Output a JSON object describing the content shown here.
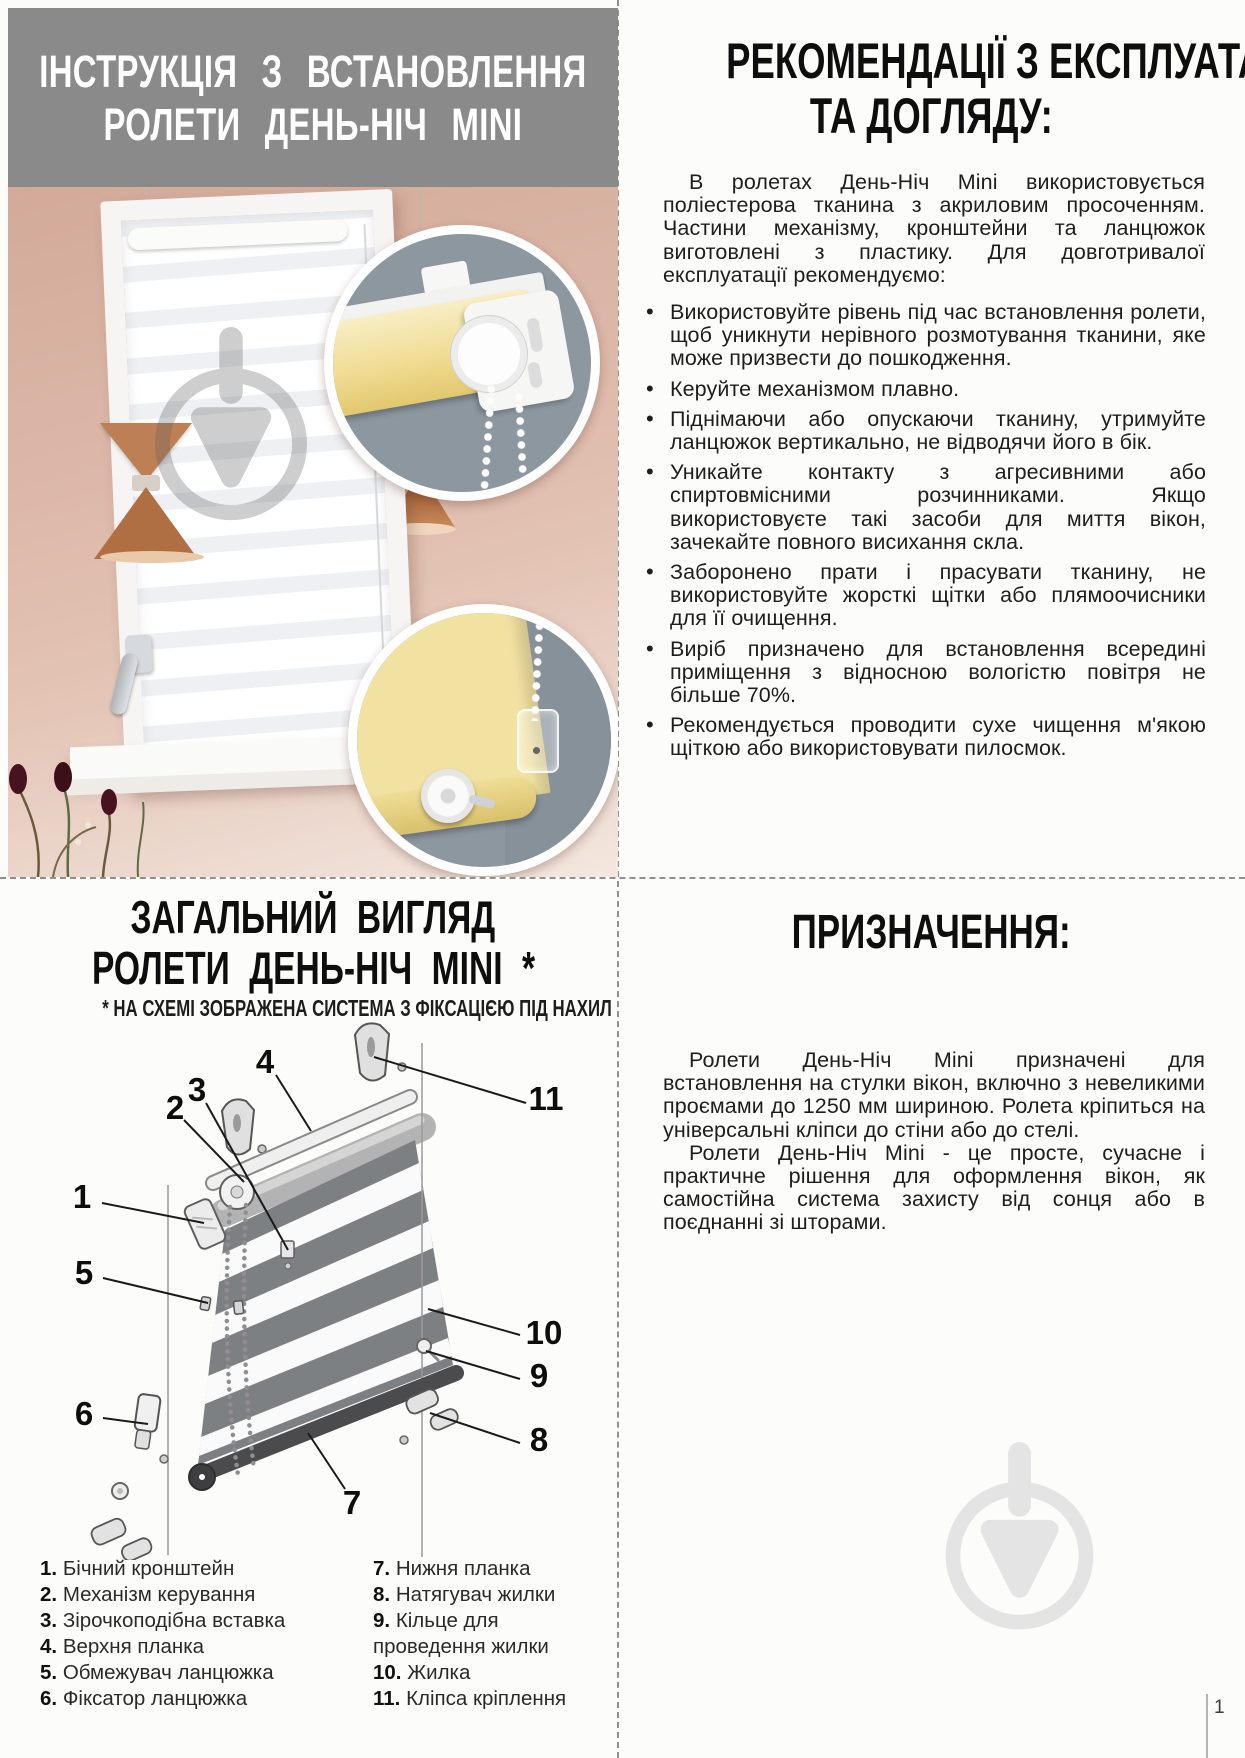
{
  "page": {
    "number": "1"
  },
  "colors": {
    "header_gray": "#8a8a8a",
    "wall_pink": "#dcb7a7",
    "inset_slate": "#8d97a0",
    "fabric_yellow": "#f2e2a0",
    "copper": "#b97a4e",
    "diagram_fabric": "#7d8083",
    "watermark_light": "#e4e4e4",
    "dashed_divider": "#909090"
  },
  "install": {
    "title_line1": "ІНСТРУКЦІЯ З ВСТАНОВЛЕННЯ",
    "title_line2": "РОЛЕТИ ДЕНЬ-НІЧ MINI"
  },
  "recommendations": {
    "title_line1": "РЕКОМЕНДАЦІЇ З ЕКСПЛУАТАЦІЇ",
    "title_line2": "ТА ДОГЛЯДУ:",
    "intro": "В ролетах День-Ніч Mini використовується поліестерова тканина з акриловим просоченням. Частини механізму, кронштейни та ланцюжок виготовлені з пластику. Для довготривалої експлуатації рекомендуємо:",
    "bullets": [
      "Використовуйте рівень під час встановлення ролети, щоб уникнути нерівного розмотування тканини, яке може призвести до пошкодження.",
      "Керуйте механізмом плавно.",
      "Піднімаючи або опускаючи тканину, утримуйте ланцюжок вертикально, не відводячи його в бік.",
      "Уникайте контакту з агресивними або спиртовмісними розчинниками. Якщо використовуєте такі засоби для миття вікон, зачекайте повного висихання скла.",
      "Заборонено прати і прасувати тканину, не використовуйте жорсткі щітки або плямоочисники для її очищення.",
      "Виріб призначено для встановлення всередині приміщення з відносною вологістю повітря не більше 70%.",
      "Рекомендується проводити сухе чищення м'якою щіткою або використовувати пилосмок."
    ]
  },
  "overview": {
    "title_line1": "ЗАГАЛЬНИЙ ВИГЛЯД",
    "title_line2": "РОЛЕТИ ДЕНЬ-НІЧ MINI *",
    "subtitle": "* НА СХЕМІ ЗОБРАЖЕНА СИСТЕМА З ФІКСАЦІЄЮ ПІД НАХИЛ",
    "callout_numbers": [
      "1",
      "2",
      "3",
      "4",
      "5",
      "6",
      "7",
      "8",
      "9",
      "10",
      "11"
    ],
    "legend_left": [
      {
        "num": "1.",
        "label": "Бічний кронштейн"
      },
      {
        "num": "2.",
        "label": "Механізм керування"
      },
      {
        "num": "3.",
        "label": "Зірочкоподібна вставка"
      },
      {
        "num": "4.",
        "label": "Верхня планка"
      },
      {
        "num": "5.",
        "label": "Обмежувач ланцюжка"
      },
      {
        "num": "6.",
        "label": "Фіксатор ланцюжка"
      }
    ],
    "legend_right": [
      {
        "num": "7.",
        "label": "Нижня планка"
      },
      {
        "num": "8.",
        "label": "Натягувач жилки"
      },
      {
        "num": "9.",
        "label": "Кільце для проведення жилки"
      },
      {
        "num": "10.",
        "label": "Жилка"
      },
      {
        "num": "11.",
        "label": "Кліпса кріплення"
      }
    ]
  },
  "purpose": {
    "title": "ПРИЗНАЧЕННЯ:",
    "paragraph1": "Ролети День-Ніч Mini призначені для встановлення на стулки вікон, включно з невеликими проємами до 1250 мм шириною. Ролета кріпиться на універсальні кліпси до стіни або до стелі.",
    "paragraph2": "Ролети День-Ніч Mini - це просте, сучасне і практичне рішення для оформлення вікон, як самостійна система захисту від сонця або в поєднанні зі шторами."
  }
}
